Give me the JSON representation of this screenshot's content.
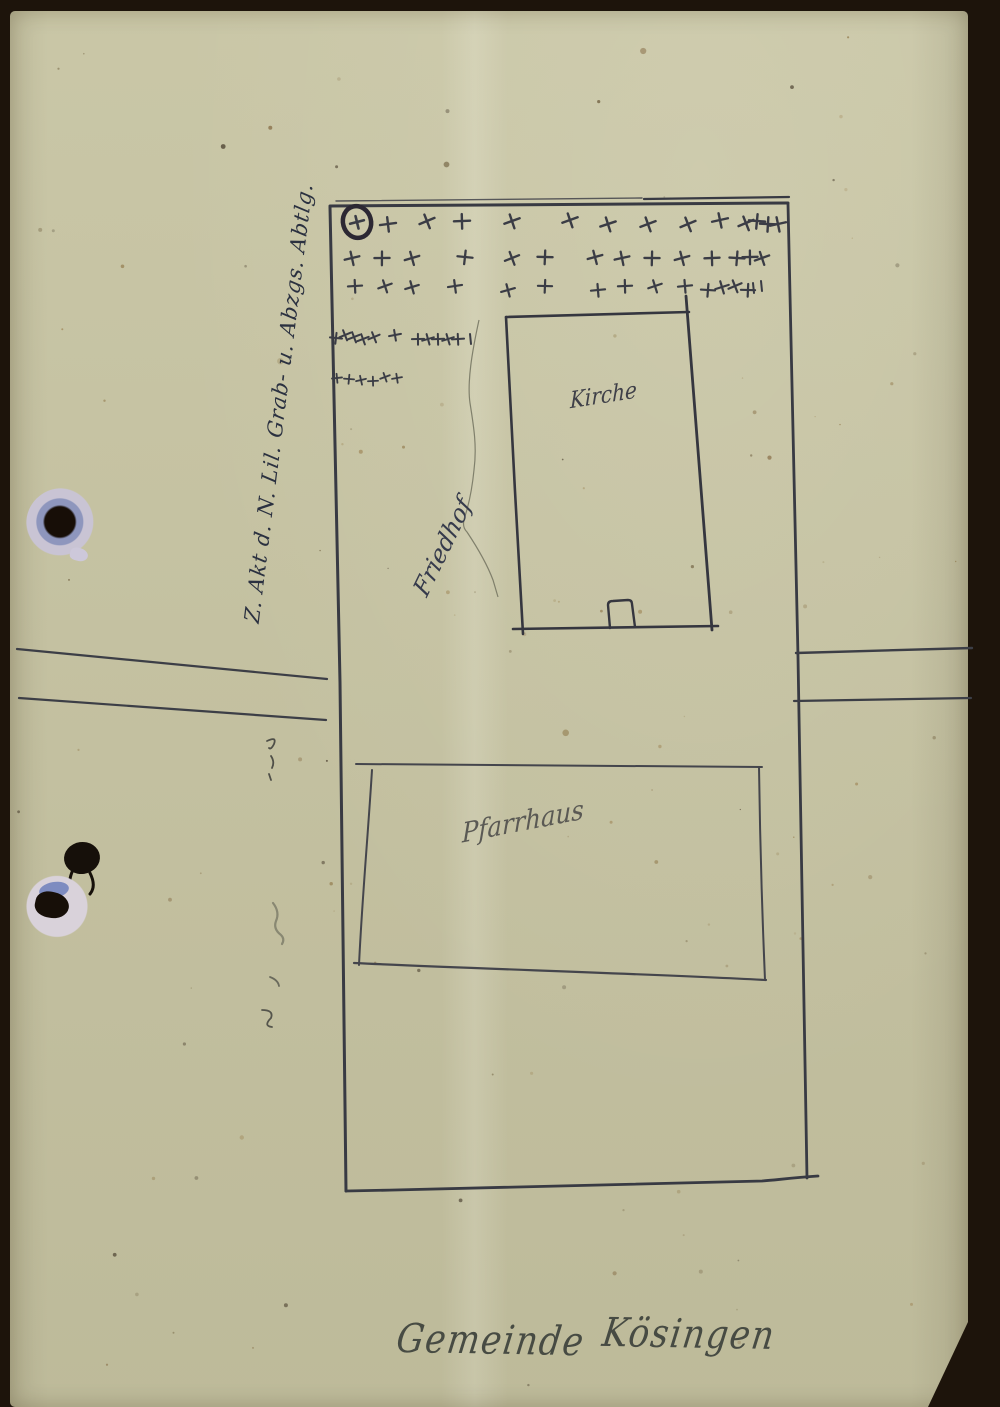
{
  "page": {
    "frame_color": "#1d140b",
    "paper_color": "#c6c3a2"
  },
  "labels": {
    "church": "Kirche",
    "cemetery": "Friedhof",
    "parsonage": "Pfarrhaus",
    "margin_note": "Z. Akt d. N. Lil. Grab- u. Abzgs. Abtlg.",
    "caption_word1": "Gemeinde",
    "caption_word2": "Kösingen"
  },
  "symbols": {
    "grave_cross": "+",
    "circled_grave_cross": "⊕"
  },
  "colors": {
    "pencil": "#3a3c45",
    "ink": "#2b3140",
    "punch_ring": "#c9c4d4",
    "punch_ring_blue": "#8e97bf",
    "hole": "#170e07"
  },
  "crosses": {
    "circled": {
      "x": 357,
      "y": 222
    },
    "rows": [
      {
        "y": 222,
        "size": 8,
        "width": 2.4,
        "xs": [
          388,
          427,
          462,
          512,
          570,
          608,
          648,
          688,
          720,
          746,
          757,
          768,
          778
        ]
      },
      {
        "y": 259,
        "size": 7.5,
        "width": 2.3,
        "xs": [
          352,
          382,
          412,
          465,
          512,
          545,
          595,
          622,
          652,
          682,
          712,
          737,
          750,
          762
        ]
      },
      {
        "y": 288,
        "size": 7,
        "width": 2.2,
        "xs": [
          355,
          385,
          412,
          455,
          508,
          545,
          598,
          625,
          655,
          685,
          708,
          722,
          735,
          748
        ]
      },
      {
        "y": 337,
        "size": 6,
        "width": 2.0,
        "xs": [
          336,
          345,
          354,
          363,
          374,
          395,
          418,
          428,
          438,
          448,
          458
        ]
      },
      {
        "y": 379,
        "size": 5,
        "width": 1.8,
        "xs": [
          337,
          349,
          361,
          373,
          385,
          397
        ]
      }
    ],
    "ticks": [
      [
        470,
        334
      ],
      [
        753,
        283
      ],
      [
        761,
        281
      ]
    ]
  }
}
